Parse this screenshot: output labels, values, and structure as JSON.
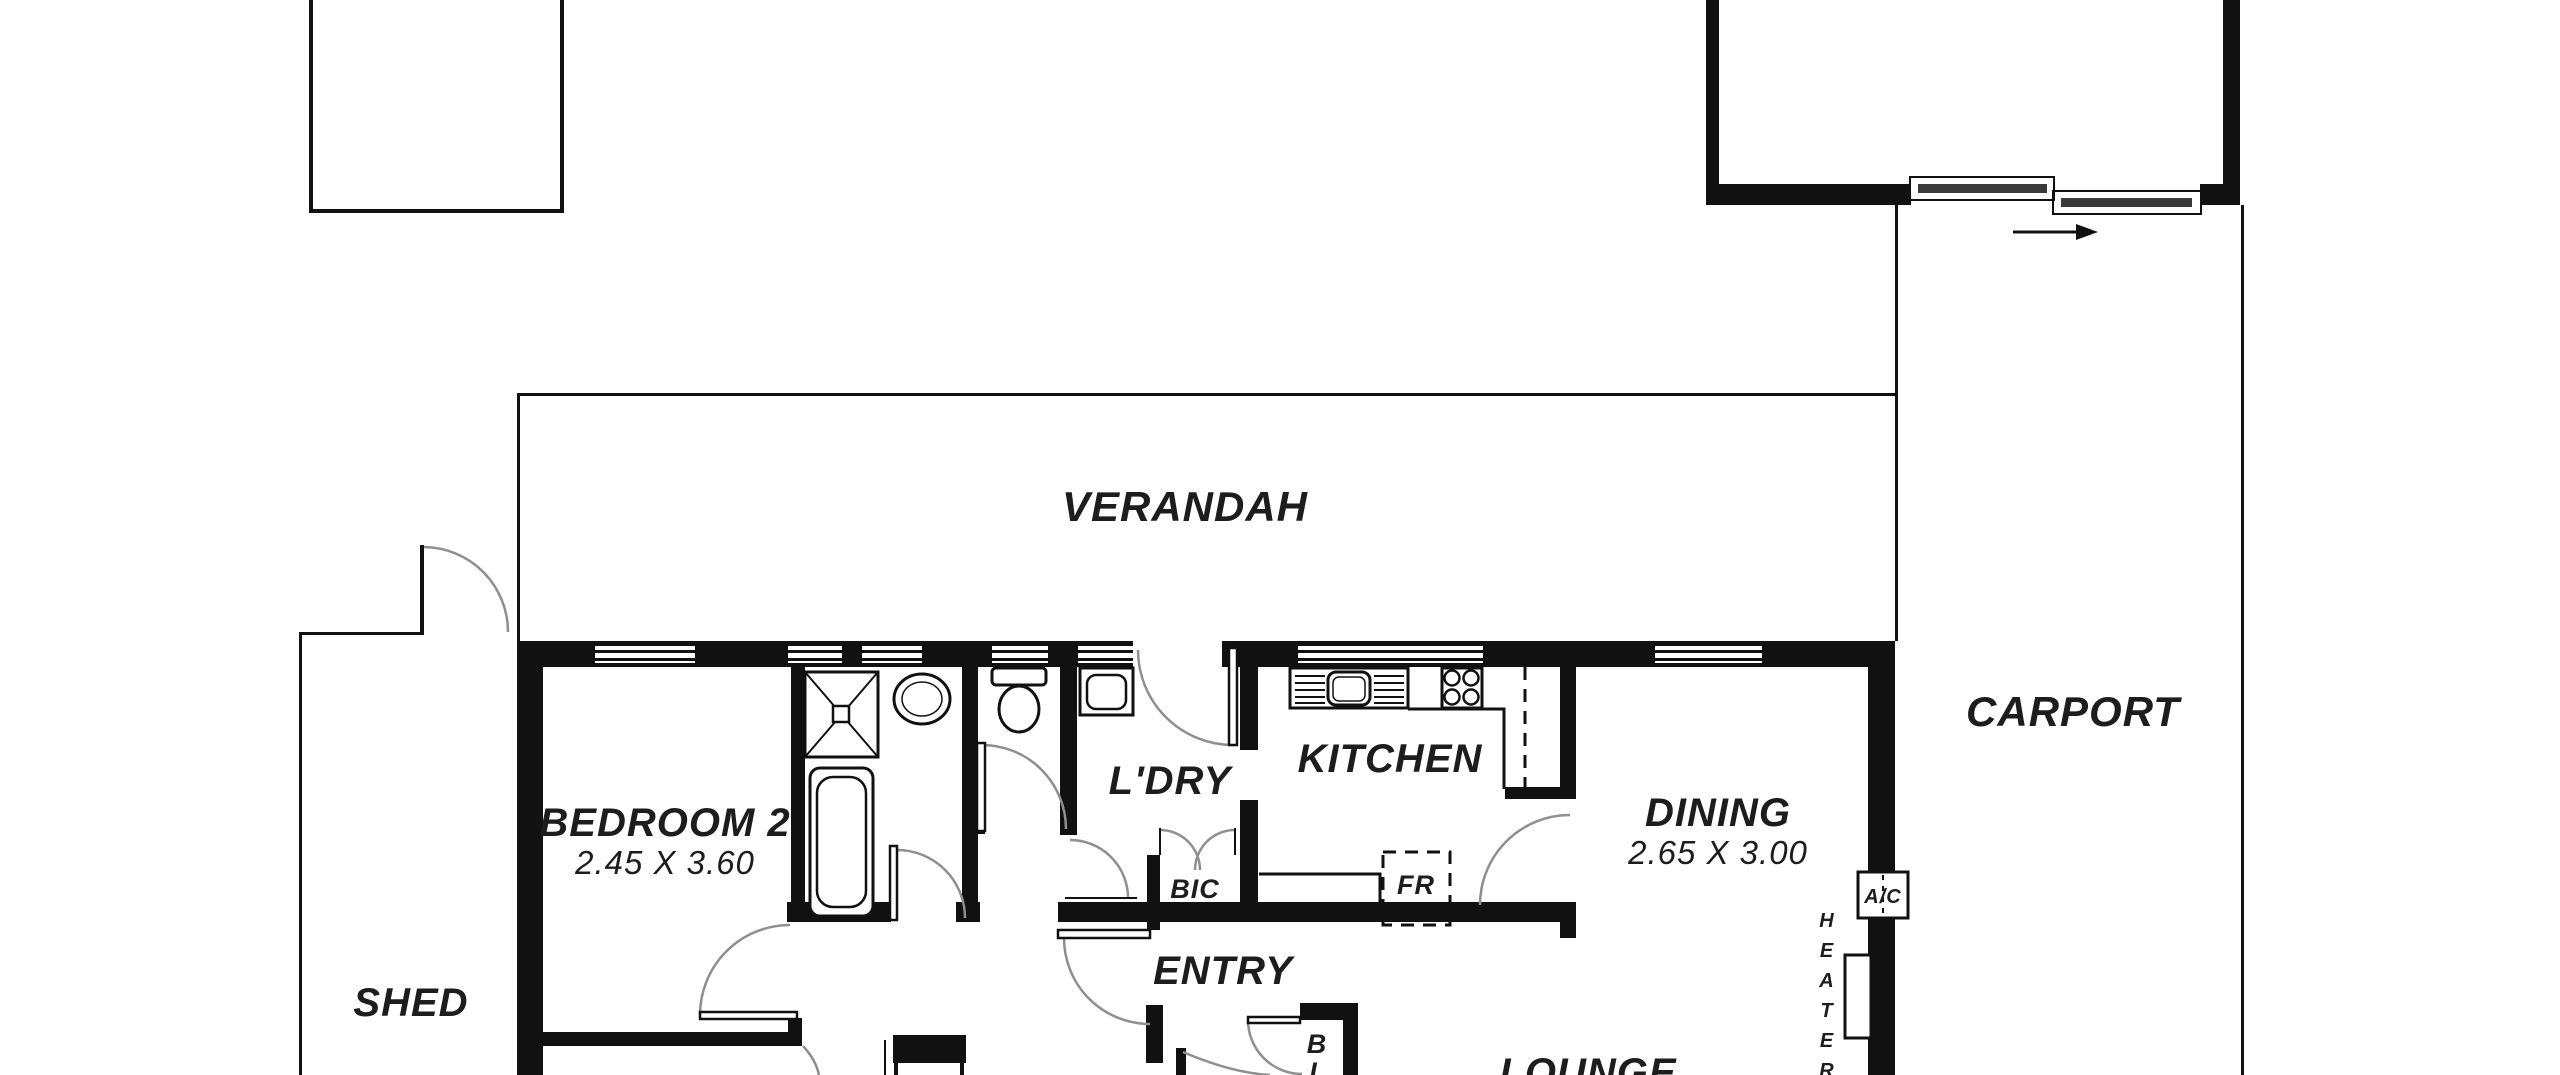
{
  "plan": {
    "title": "Residential floor plan",
    "colors": {
      "background": "#ffffff",
      "ink": "#111111",
      "door_arc": "#8f8f8f"
    },
    "rooms": {
      "verandah": "VERANDAH",
      "carport": "CARPORT",
      "shed": "SHED",
      "bedroom2_name": "BEDROOM 2",
      "bedroom2_size": "2.45 X 3.60",
      "laundry": "L'DRY",
      "kitchen": "KITCHEN",
      "dining_name": "DINING",
      "dining_size": "2.65 X 3.00",
      "entry": "ENTRY",
      "lounge": "LOUNGE"
    },
    "fixtures": {
      "built_in_cupboard": "BIC",
      "fridge": "FR",
      "air_conditioner": "A/C",
      "closet_b": "B",
      "closet_l": "L",
      "heater_vertical": [
        "H",
        "E",
        "A",
        "T",
        "E",
        "R"
      ]
    }
  }
}
